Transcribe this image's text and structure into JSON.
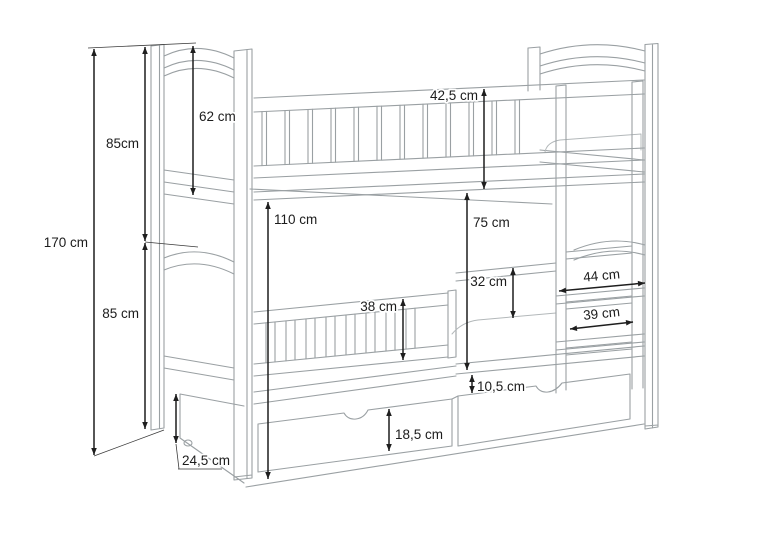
{
  "page": {
    "width_px": 768,
    "height_px": 543,
    "background": "#ffffff"
  },
  "diagram": {
    "type": "dimensioned-technical-line-drawing",
    "subject": "bunk bed with headboards, guard rails, hook-on ladder and two under-bed drawers",
    "unit": "cm",
    "colors": {
      "furniture_outline": "#9aa0a3",
      "furniture_light": "#b3b8ba",
      "dimension_line": "#1e1e1e",
      "label_text": "#1c1c1c",
      "background": "#ffffff"
    },
    "dimensions": [
      {
        "id": "total-height",
        "label": "170 cm",
        "value_cm": 170
      },
      {
        "id": "upper-section-height",
        "label": "85cm",
        "value_cm": 85
      },
      {
        "id": "lower-section-height",
        "label": "85 cm",
        "value_cm": 85
      },
      {
        "id": "upper-headboard-height",
        "label": "62 cm",
        "value_cm": 62
      },
      {
        "id": "upper-platform-height",
        "label": "110 cm",
        "value_cm": 110
      },
      {
        "id": "upper-guardrail-height",
        "label": "42,5 cm",
        "value_cm": 42.5
      },
      {
        "id": "bunk-clearance",
        "label": "75 cm",
        "value_cm": 75
      },
      {
        "id": "lower-guardrail-gap",
        "label": "32 cm",
        "value_cm": 32
      },
      {
        "id": "lower-guardrail-height",
        "label": "38 cm",
        "value_cm": 38
      },
      {
        "id": "ladder-outer-width",
        "label": "44 cm",
        "value_cm": 44
      },
      {
        "id": "ladder-inner-width",
        "label": "39 cm",
        "value_cm": 39
      },
      {
        "id": "under-bed-gap",
        "label": "10,5 cm",
        "value_cm": 10.5
      },
      {
        "id": "drawer-front-height",
        "label": "18,5 cm",
        "value_cm": 18.5
      },
      {
        "id": "foot-clearance-height",
        "label": "24,5 cm",
        "value_cm": 24.5
      }
    ]
  }
}
